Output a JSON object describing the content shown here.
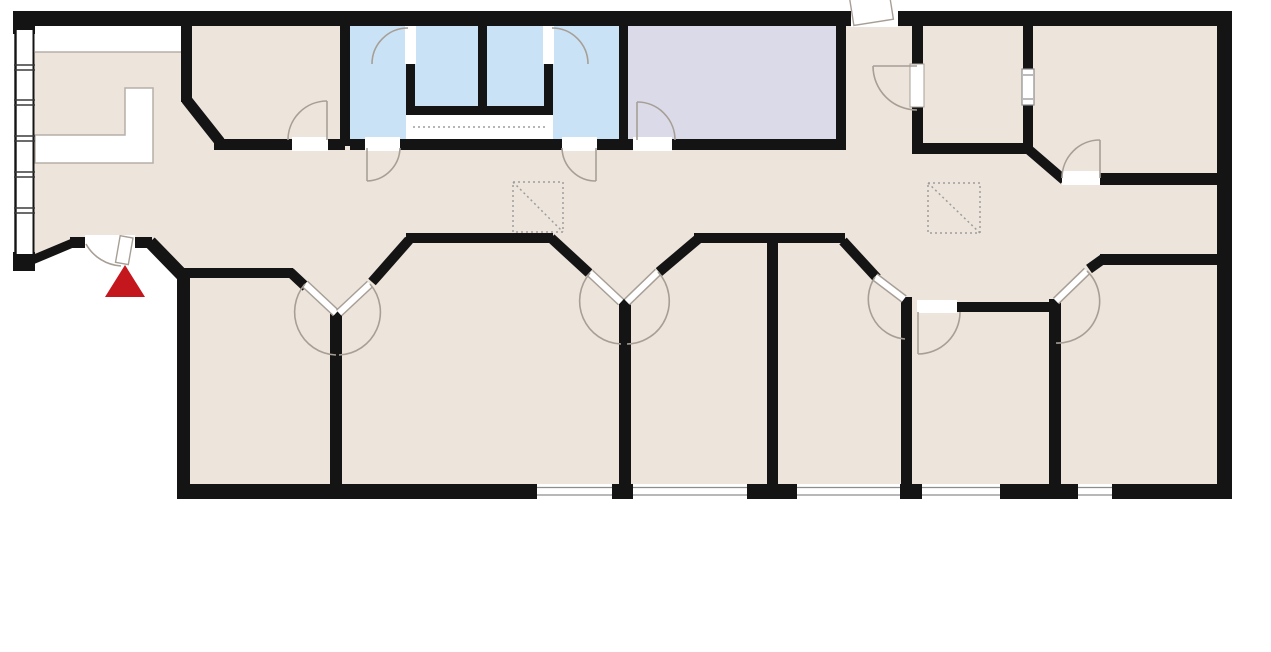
{
  "title": "office-floor-plan",
  "colors": {
    "background": "#FFFFFF",
    "wall": "#141414",
    "floor": "#EDE5DC",
    "room_blue": "#C9E2F6",
    "room_lavender": "#DBDAE8",
    "fixture_white": "#FFFFFF",
    "door_line": "#A79F96",
    "desk_line": "#B6AFA6",
    "window_line": "#8D8D8D",
    "dashed_line": "#9D9D9D",
    "entrance_red": "#C3161D"
  },
  "floorplan": {
    "kind": "architectural floor plan, no text labels",
    "highlight_rooms": {
      "blue_rooms": 4,
      "lavender_rooms": 1
    },
    "symbols": {
      "entrance_marker": "red triangle outside main entrance at lower left",
      "shaft_symbols": 2,
      "bottom_wall_windows": 5,
      "left_wall_window_band": 1,
      "reception_desk": "white L-shaped counter in upper-left room"
    }
  }
}
